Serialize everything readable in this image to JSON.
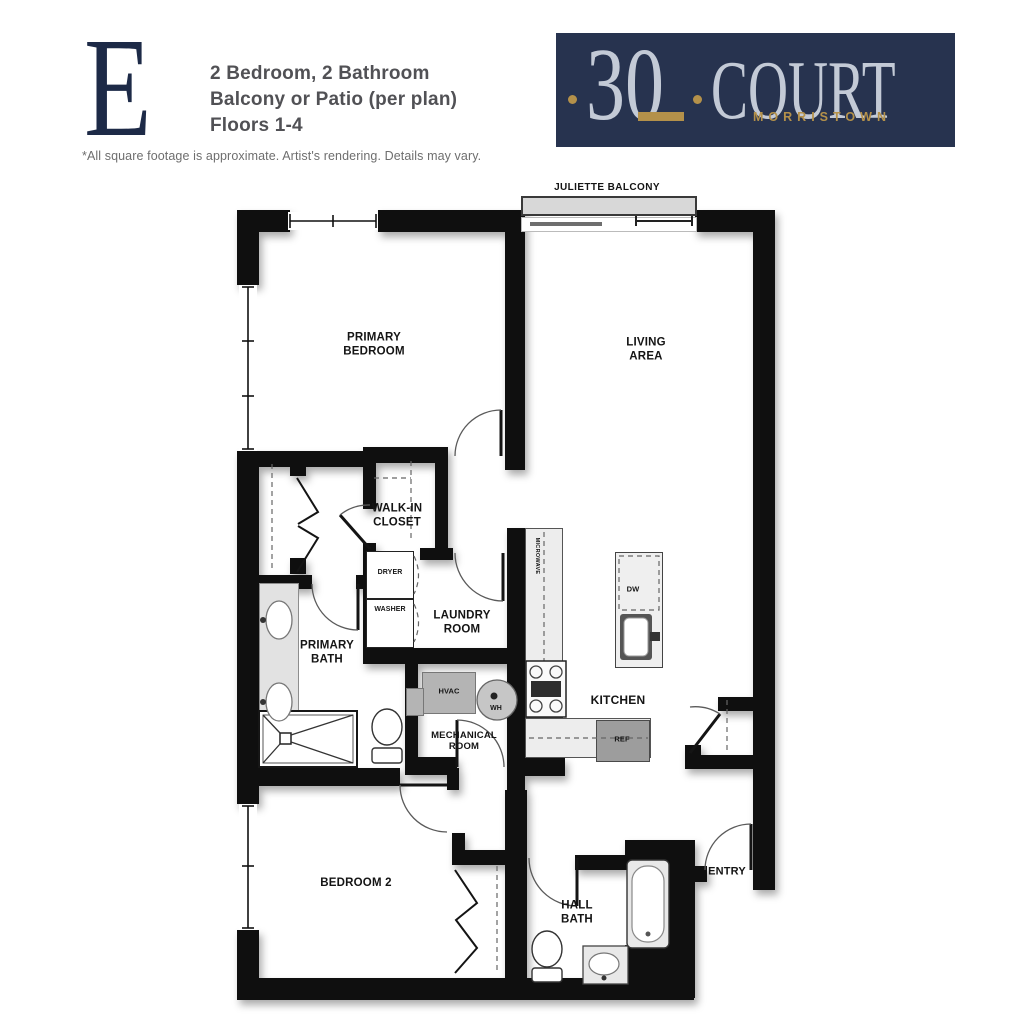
{
  "header": {
    "plan_letter": "E",
    "line1": "2 Bedroom, 2 Bathroom",
    "line2": "Balcony or Patio (per plan)",
    "line3": "Floors 1-4",
    "disclaimer": "*All square footage is approximate. Artist's rendering. Details may vary."
  },
  "logo": {
    "number": "30",
    "name": "COURT",
    "city": "MORRISTOWN",
    "colors": {
      "background": "#27334f",
      "lettering": "#c3cad6",
      "accent": "#b4914a"
    }
  },
  "floorplan": {
    "balcony": "JULIETTE BALCONY",
    "rooms": {
      "primary_bedroom": "PRIMARY\nBEDROOM",
      "living_area": "LIVING\nAREA",
      "walk_in_closet": "WALK-IN\nCLOSET",
      "laundry_room": "LAUNDRY\nROOM",
      "primary_bath": "PRIMARY\nBATH",
      "kitchen": "KITCHEN",
      "mechanical_room": "MECHANICAL\nROOM",
      "bedroom_2": "BEDROOM 2",
      "hall_bath": "HALL\nBATH",
      "entry": "ENTRY"
    },
    "fixtures": {
      "dryer": "DRYER",
      "washer": "WASHER",
      "dishwasher": "DW",
      "refrigerator": "REF",
      "hvac": "HVAC",
      "water_heater": "WH",
      "microwave": "MICROWAVE"
    }
  }
}
